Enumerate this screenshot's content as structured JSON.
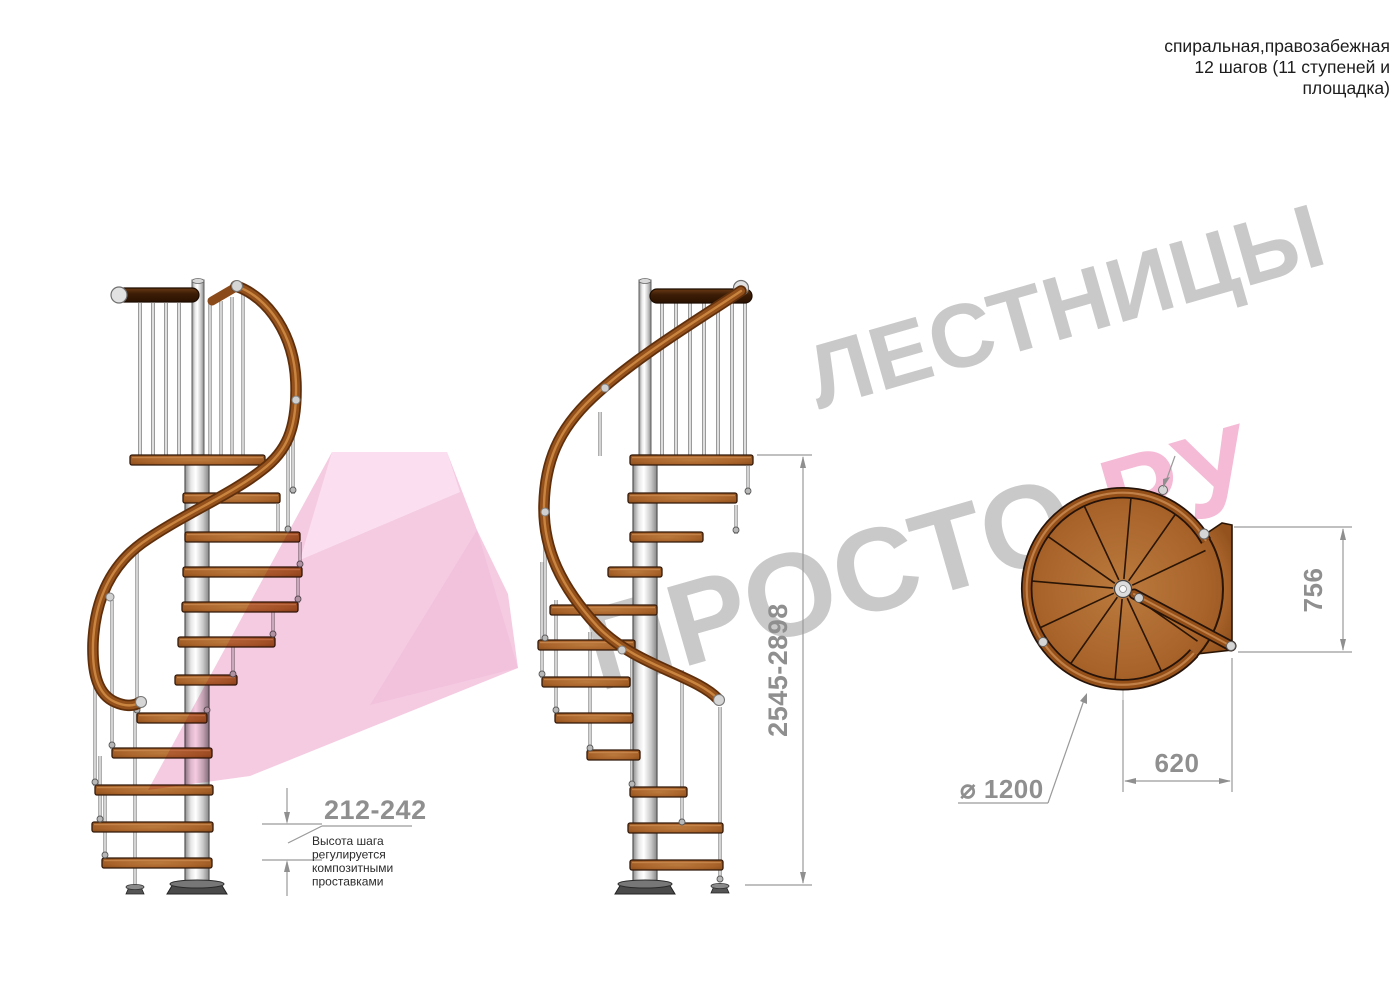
{
  "title": {
    "line1": "спиральная,правозабежная",
    "line2": "12 шагов (11 ступеней и",
    "line3": "площадка)"
  },
  "watermark": {
    "word1": "ЛЕСТНИЦЫ",
    "word2": "ПРОСТО",
    "word2_suffix": ".РУ"
  },
  "annotations": {
    "step_height": "212-242",
    "note_lines": [
      "Высота шага",
      "регулируется",
      "композитными",
      "проставками"
    ],
    "total_height": "2545-2898",
    "plan_depth": "756",
    "plan_width": "620",
    "plan_diameter": "⌀ 1200"
  },
  "colors": {
    "watermark_gray": "#c9c9c9",
    "watermark_pink": "#f5bad6",
    "dimension_gray": "#8f8f8f",
    "wood_tread": "#a8632a",
    "handrail_wood": "#94511c",
    "dark_rail_wood": "#4a2508",
    "metal_pole": "#d9d9d9"
  }
}
